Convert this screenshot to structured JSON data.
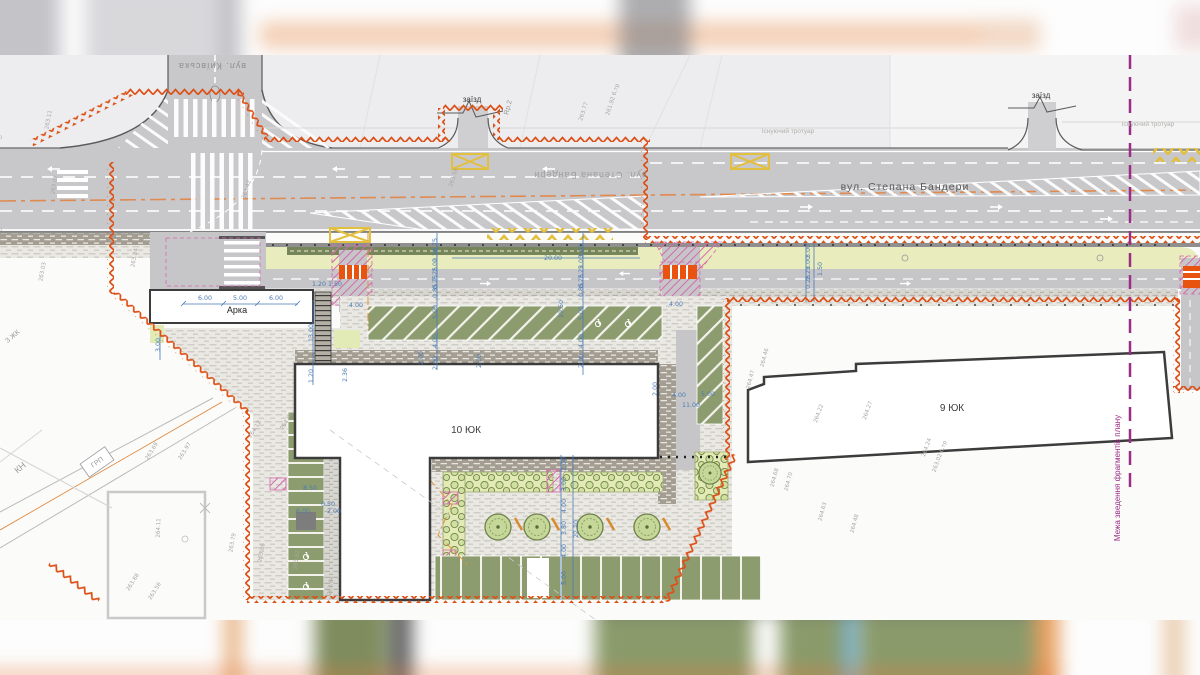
{
  "labels": {
    "street_top": "вул. Київська",
    "street_main": "вул. Степана Бандери",
    "entry": "заїзд",
    "sidewalk": "Існуючий тротуар",
    "sidewalk_lc": "існуючий тротуар",
    "arch": "Арка",
    "building_10": "10 ЮК",
    "building_9": "9 ЮК",
    "boundary_note": "Межа зведення фрагментів плану",
    "marker_rp2": "Rp.2",
    "marker_kn": "КН",
    "marker_grp": "ГРП",
    "marker_zhk": "3 ЖК"
  },
  "colors": {
    "boundary_orange": "#dd4f15",
    "marking_yellow": "#e3bf3f",
    "fragment_purple": "#9b2d86",
    "dimension_blue": "#4a7ab5",
    "detail_pink": "#d667ad",
    "axis_orange": "#e08a50",
    "green_strip": "#e9ecbd",
    "parking_green": "#8d9c6f",
    "road_gray": "#c8c8cb"
  },
  "dimensions": [
    {
      "x": 205,
      "y": 300,
      "r": 0,
      "v": "6.00"
    },
    {
      "x": 240,
      "y": 300,
      "r": 0,
      "v": "5.00"
    },
    {
      "x": 276,
      "y": 300,
      "r": 0,
      "v": "6.00"
    },
    {
      "x": 160,
      "y": 345,
      "r": -90,
      "v": "3.00"
    },
    {
      "x": 327,
      "y": 286,
      "r": 0,
      "v": "1.20 1.50"
    },
    {
      "x": 313,
      "y": 333,
      "r": -90,
      "v": "13.00"
    },
    {
      "x": 313,
      "y": 376,
      "r": -90,
      "v": "1.20"
    },
    {
      "x": 356,
      "y": 307,
      "r": 0,
      "v": "4.00"
    },
    {
      "x": 347,
      "y": 375,
      "r": -90,
      "v": "2.36"
    },
    {
      "x": 553,
      "y": 260,
      "r": 0,
      "v": "20.00"
    },
    {
      "x": 563,
      "y": 309,
      "r": -90,
      "v": "19.50"
    },
    {
      "x": 437,
      "y": 245,
      "r": -90,
      "v": "0.75"
    },
    {
      "x": 437,
      "y": 255,
      "r": -90,
      "v": "2.26"
    },
    {
      "x": 437,
      "y": 265,
      "r": -90,
      "v": "2.00"
    },
    {
      "x": 437,
      "y": 274,
      "r": -90,
      "v": "2.25"
    },
    {
      "x": 437,
      "y": 282,
      "r": -90,
      "v": "0.25"
    },
    {
      "x": 437,
      "y": 291,
      "r": -90,
      "v": "0.85"
    },
    {
      "x": 437,
      "y": 312,
      "r": -90,
      "v": "5.00"
    },
    {
      "x": 437,
      "y": 341,
      "r": -90,
      "v": "4.00"
    },
    {
      "x": 437,
      "y": 363,
      "r": -90,
      "v": "2.00"
    },
    {
      "x": 583,
      "y": 251,
      "r": -90,
      "v": "3.00"
    },
    {
      "x": 583,
      "y": 262,
      "r": -90,
      "v": "2.00"
    },
    {
      "x": 583,
      "y": 272,
      "r": -90,
      "v": "2.25"
    },
    {
      "x": 583,
      "y": 281,
      "r": -90,
      "v": "0.25"
    },
    {
      "x": 583,
      "y": 290,
      "r": -90,
      "v": "0.85"
    },
    {
      "x": 583,
      "y": 313,
      "r": -90,
      "v": "5.00"
    },
    {
      "x": 583,
      "y": 341,
      "r": -90,
      "v": "4.00"
    },
    {
      "x": 583,
      "y": 361,
      "r": -90,
      "v": "2.00"
    },
    {
      "x": 810,
      "y": 251,
      "r": -90,
      "v": "3.00"
    },
    {
      "x": 810,
      "y": 263,
      "r": -90,
      "v": "2.00"
    },
    {
      "x": 810,
      "y": 273,
      "r": -90,
      "v": "2.25"
    },
    {
      "x": 810,
      "y": 282,
      "r": -90,
      "v": "0.25"
    },
    {
      "x": 822,
      "y": 269,
      "r": -90,
      "v": "1.50"
    },
    {
      "x": 676,
      "y": 306,
      "r": 0,
      "v": "4.00"
    },
    {
      "x": 657,
      "y": 389,
      "r": -90,
      "v": "2.00"
    },
    {
      "x": 679,
      "y": 397,
      "r": 0,
      "v": "4.00"
    },
    {
      "x": 708,
      "y": 396,
      "r": 0,
      "v": "5.00"
    },
    {
      "x": 691,
      "y": 407,
      "r": 0,
      "v": "11.00"
    },
    {
      "x": 566,
      "y": 464,
      "r": -90,
      "v": "2.00"
    },
    {
      "x": 566,
      "y": 484,
      "r": -90,
      "v": "3.00"
    },
    {
      "x": 566,
      "y": 506,
      "r": -90,
      "v": "4.00"
    },
    {
      "x": 566,
      "y": 528,
      "r": -90,
      "v": "3.80"
    },
    {
      "x": 578,
      "y": 529,
      "r": -90,
      "v": "22.20"
    },
    {
      "x": 566,
      "y": 551,
      "r": -90,
      "v": "4.00"
    },
    {
      "x": 566,
      "y": 578,
      "r": -90,
      "v": "5.00"
    },
    {
      "x": 310,
      "y": 490,
      "r": 0,
      "v": "8.50"
    },
    {
      "x": 328,
      "y": 506,
      "r": 0,
      "v": "0.50"
    },
    {
      "x": 303,
      "y": 513,
      "r": 0,
      "v": "6.00"
    },
    {
      "x": 334,
      "y": 513,
      "r": 0,
      "v": "2.00"
    },
    {
      "x": 423,
      "y": 358,
      "r": -90,
      "v": "2.00"
    },
    {
      "x": 481,
      "y": 361,
      "r": -90,
      "v": "2.00"
    }
  ],
  "survey_points": [
    {
      "x": 50,
      "y": 120,
      "r": -80,
      "v": "263.11"
    },
    {
      "x": 56,
      "y": 185,
      "r": -80,
      "v": "263.07"
    },
    {
      "x": 44,
      "y": 272,
      "r": -80,
      "v": "263.03"
    },
    {
      "x": 136,
      "y": 258,
      "r": -80,
      "v": "263.24"
    },
    {
      "x": 248,
      "y": 190,
      "r": -72,
      "v": "263.42"
    },
    {
      "x": 455,
      "y": 178,
      "r": -72,
      "v": "263.58"
    },
    {
      "x": 585,
      "y": 112,
      "r": -72,
      "v": "263.77"
    },
    {
      "x": 614,
      "y": 100,
      "r": -72,
      "v": "261.92 6.тр"
    },
    {
      "x": 186,
      "y": 452,
      "r": -58,
      "v": "263.97"
    },
    {
      "x": 256,
      "y": 430,
      "r": -58,
      "v": "264.12"
    },
    {
      "x": 288,
      "y": 422,
      "r": -58,
      "v": "264.04"
    },
    {
      "x": 153,
      "y": 452,
      "r": -58,
      "v": "263.69"
    },
    {
      "x": 160,
      "y": 528,
      "r": -88,
      "v": "264.11"
    },
    {
      "x": 234,
      "y": 543,
      "r": -80,
      "v": "263.79"
    },
    {
      "x": 263,
      "y": 553,
      "r": -80,
      "v": "263.86"
    },
    {
      "x": 134,
      "y": 583,
      "r": -58,
      "v": "263.88"
    },
    {
      "x": 156,
      "y": 592,
      "r": -58,
      "v": "263.58"
    },
    {
      "x": 298,
      "y": 560,
      "r": -82,
      "v": "263.82"
    },
    {
      "x": 332,
      "y": 586,
      "r": -82,
      "v": "263.64"
    },
    {
      "x": 766,
      "y": 358,
      "r": -75,
      "v": "264.46"
    },
    {
      "x": 752,
      "y": 380,
      "r": -75,
      "v": "264.47"
    },
    {
      "x": 820,
      "y": 414,
      "r": -70,
      "v": "264.22"
    },
    {
      "x": 869,
      "y": 411,
      "r": -70,
      "v": "264.27"
    },
    {
      "x": 928,
      "y": 448,
      "r": -70,
      "v": "264.24"
    },
    {
      "x": 941,
      "y": 457,
      "r": -70,
      "v": "263.02 6.тр"
    },
    {
      "x": 776,
      "y": 478,
      "r": -75,
      "v": "264.68"
    },
    {
      "x": 790,
      "y": 482,
      "r": -75,
      "v": "264.70"
    },
    {
      "x": 824,
      "y": 512,
      "r": -75,
      "v": "264.63"
    },
    {
      "x": 856,
      "y": 524,
      "r": -75,
      "v": "264.48"
    }
  ]
}
